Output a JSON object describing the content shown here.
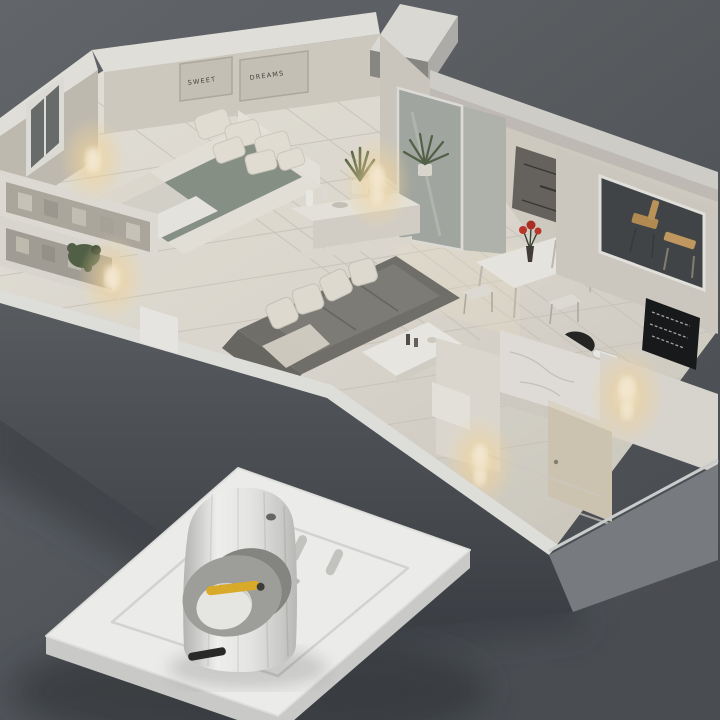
{
  "meta": {
    "title": "3D cutaway apartment model with smart night-light plugged into a wall outlet plate"
  },
  "wall_art": {
    "frame1_text": "SWEET",
    "frame2_text": "DREAMS"
  },
  "palette": {
    "bg_top": "#676b6f",
    "bg_bottom": "#4e5257",
    "floor": "#e7e3da",
    "tile_line": "#d2cec4",
    "wall_top": "#efeeea",
    "wall_face": "#d9d4ca",
    "wall_face_shadow": "#c6c1b7",
    "outer_face_dark": "#50545a",
    "outer_face_right": "#7e8286",
    "sofa": "#75746e",
    "sofa_seat": "#83827c",
    "pillow": "#e9e5db",
    "blanket_bed": "#8d978c",
    "glow": "#ffdfa6",
    "glow_core": "#fff3d9",
    "plant_green": "#55654a",
    "flower_red": "#c5392c",
    "wood": "#bb9257",
    "plaque_dark": "#191b1d",
    "glass": "#a9aea8",
    "plate": "#f6f6f4",
    "plate_side": "#d4d4d2",
    "device_edge": "#c2c2c0",
    "accent_yellow": "#e5b32c",
    "slot_dark": "#2c2c2a"
  }
}
